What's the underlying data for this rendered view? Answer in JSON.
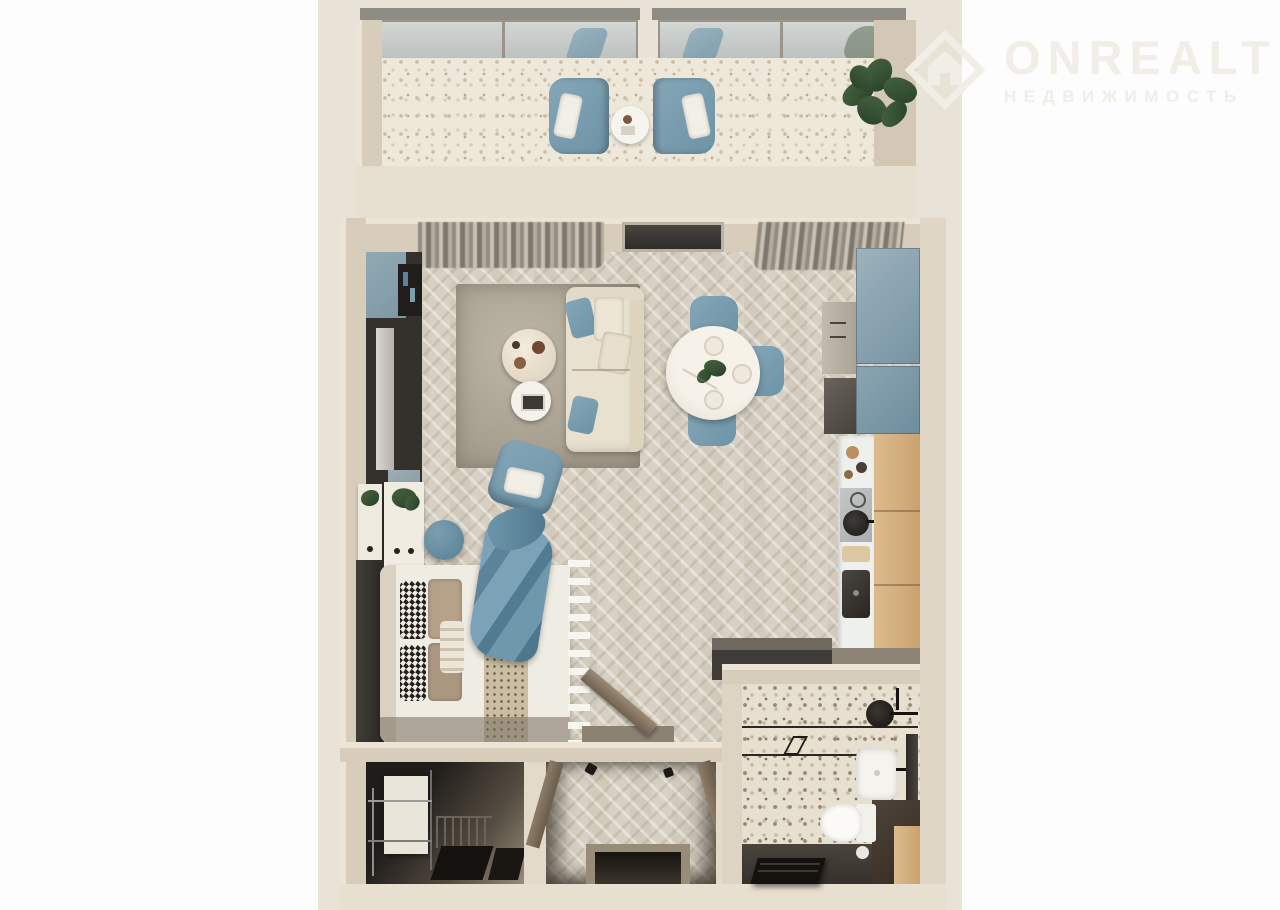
{
  "watermark": {
    "brand": "ONREALT",
    "subtitle": "НЕДВИЖИМОСТЬ",
    "icon": "house-diamond-icon",
    "color": "#f1ede7"
  },
  "palette": {
    "page_background": "#fdfdfd",
    "plan_background": "#e9e2d6",
    "walls": "#d8cdbb",
    "parquet_floor": "#d8d1c3",
    "terrazzo_floor": "#eee8da",
    "accent_blue": "#7d9fb0",
    "sofa_cream": "#e9e1d0",
    "oak_wood": "#d6b383",
    "charcoal": "#34302b",
    "bathroom_dark_floor": "#46413b"
  },
  "scene": {
    "type": "3d-top-down-floor-plan",
    "subject": "studio apartment render",
    "rooms": [
      {
        "name": "balcony",
        "floor": "terrazzo",
        "furniture": [
          "glass-railing",
          "armchair",
          "armchair",
          "side-table",
          "potted-plant"
        ]
      },
      {
        "name": "living-dining",
        "floor": "herringbone-parquet",
        "furniture": [
          "curtains",
          "window",
          "tv-unit",
          "rug",
          "sofa",
          "marble-coffee-table",
          "white-coffee-table",
          "armchair",
          "pouf",
          "dining-table",
          "dining-chair",
          "dining-chair",
          "dining-chair"
        ]
      },
      {
        "name": "kitchen",
        "floor": "herringbone-parquet",
        "furniture": [
          "tall-blue-cabinets",
          "gray-cabinet",
          "oven",
          "countertop",
          "cooktop",
          "pan",
          "sink",
          "cutting-board",
          "wood-bar"
        ]
      },
      {
        "name": "sleeping-area",
        "floor": "herringbone-parquet",
        "furniture": [
          "double-bed",
          "houndstooth-pillows",
          "taupe-pillows",
          "blue-throw",
          "dresser",
          "dresser",
          "wardrobe",
          "ladder-shelf",
          "open-door"
        ]
      },
      {
        "name": "entry-hall",
        "floor": "herringbone-parquet",
        "furniture": [
          "open-door",
          "open-door",
          "entry-mat",
          "wall-hooks"
        ]
      },
      {
        "name": "walk-in-closet",
        "floor": "dark-tile",
        "furniture": [
          "white-cabinet",
          "metal-clothes-rack",
          "shoe-rack",
          "floor-mats"
        ]
      },
      {
        "name": "bathroom",
        "floor": "terrazzo-and-dark-tile",
        "furniture": [
          "shower-glass-screen",
          "shower-head",
          "washbasin",
          "mirror",
          "toilet",
          "dark-vanity",
          "wood-cabinet",
          "bench",
          "bin"
        ]
      }
    ]
  }
}
